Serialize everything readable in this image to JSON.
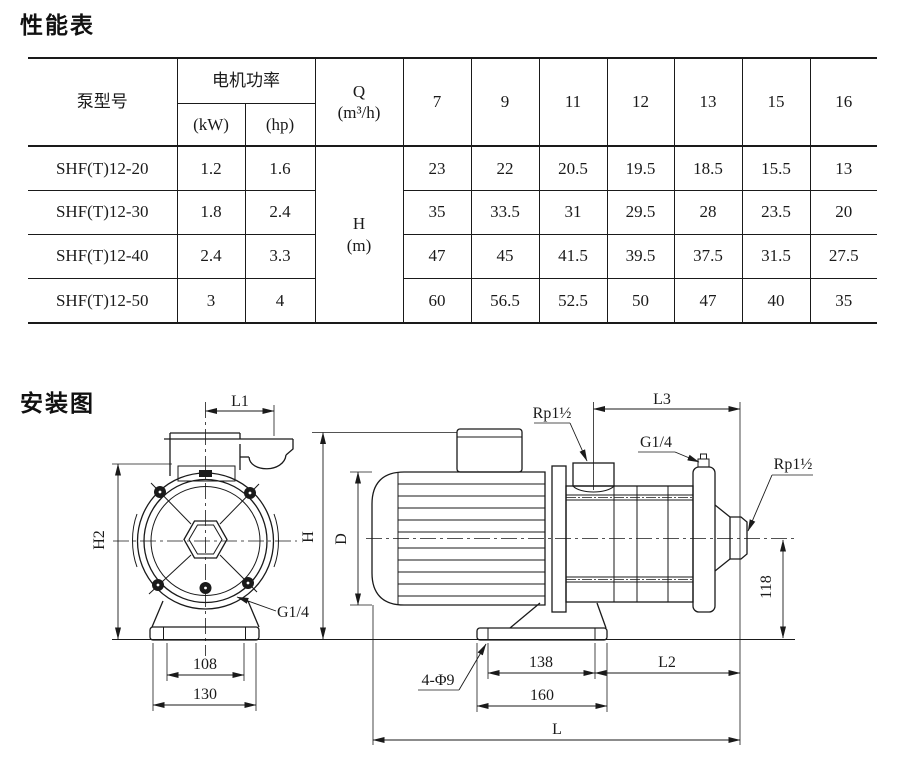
{
  "page": {
    "performance_title": "性能表",
    "installation_title": "安装图"
  },
  "table": {
    "header": {
      "model": "泵型号",
      "motor_power": "电机功率",
      "kw": "(kW)",
      "hp": "(hp)",
      "q_line1": "Q",
      "q_line2": "(m³/h)",
      "flow_values": [
        "7",
        "9",
        "11",
        "12",
        "13",
        "15",
        "16"
      ],
      "head_line1": "H",
      "head_line2": "(m)"
    },
    "rows": [
      {
        "model": "SHF(T)12-20",
        "kw": "1.2",
        "hp": "1.6",
        "heads": [
          "23",
          "22",
          "20.5",
          "19.5",
          "18.5",
          "15.5",
          "13"
        ]
      },
      {
        "model": "SHF(T)12-30",
        "kw": "1.8",
        "hp": "2.4",
        "heads": [
          "35",
          "33.5",
          "31",
          "29.5",
          "28",
          "23.5",
          "20"
        ]
      },
      {
        "model": "SHF(T)12-40",
        "kw": "2.4",
        "hp": "3.3",
        "heads": [
          "47",
          "45",
          "41.5",
          "39.5",
          "37.5",
          "31.5",
          "27.5"
        ]
      },
      {
        "model": "SHF(T)12-50",
        "kw": "3",
        "hp": "4",
        "heads": [
          "60",
          "56.5",
          "52.5",
          "50",
          "47",
          "40",
          "35"
        ]
      }
    ]
  },
  "diagram": {
    "front_view": {
      "l1": "L1",
      "h2": "H2",
      "g14": "G1/4",
      "dim108": "108",
      "dim130": "130"
    },
    "side_view": {
      "rp_inlet": "Rp1½",
      "l3": "L3",
      "g14": "G1/4",
      "rp_outlet": "Rp1½",
      "h": "H",
      "d": "D",
      "dim118": "118",
      "holes": "4-Φ9",
      "dim138": "138",
      "l2": "L2",
      "dim160": "160",
      "l": "L"
    }
  },
  "colors": {
    "ink": "#1a1a1a",
    "background": "#ffffff"
  }
}
